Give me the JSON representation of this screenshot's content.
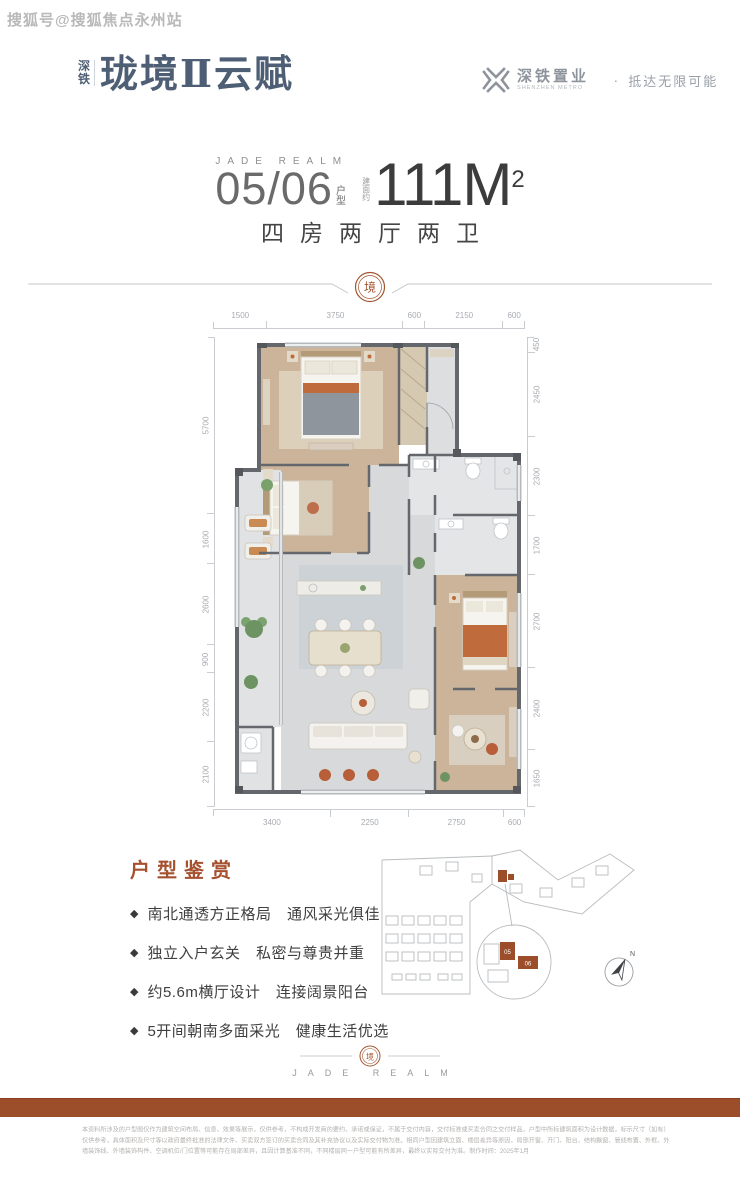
{
  "watermark": "搜狐号@搜狐焦点永州站",
  "logo": {
    "prefix_top": "深",
    "prefix_bottom": "铁",
    "name": "珑境Ⅱ云赋"
  },
  "developer": {
    "name": "深铁置业",
    "name_en": "SHENZHEN METRO",
    "separator": "·",
    "slogan": "抵达无限可能"
  },
  "headline": {
    "en_label": "JADE REALM",
    "unit_number": "05/06",
    "unit_label": "户型",
    "area_prefix": "建面约",
    "area_value": "111M",
    "area_exponent": "2",
    "rooms": "四房两厅两卫"
  },
  "divider": {
    "seal_char": "境"
  },
  "floorplan": {
    "dims_top": [
      "1500",
      "3750",
      "600",
      "2150",
      "600"
    ],
    "dims_left": [
      "5700",
      "1600",
      "2600",
      "900",
      "2200",
      "2100"
    ],
    "dims_right": [
      "450",
      "2450",
      "2300",
      "1700",
      "2700",
      "2400",
      "1650"
    ],
    "dims_bottom": [
      "3400",
      "2250",
      "2750",
      "600"
    ]
  },
  "features": {
    "title": "户型鉴赏",
    "bullet": "◆",
    "items": [
      "南北通透方正格局　通风采光俱佳",
      "独立入户玄关　私密与尊贵并重",
      "约5.6m横厅设计　连接阔景阳台",
      "5开间朝南多面采光　健康生活优选"
    ]
  },
  "siteplan": {
    "compass_label": "N",
    "unit_labels": [
      "05",
      "06"
    ]
  },
  "footer": {
    "seal_char": "境",
    "en_label": "JADE REALM"
  },
  "disclaimer": {
    "line1": "本资料所涉及的户型图仅作为建筑空间布局、信息、效果等展示，仅供参考，不构成开发商的要约、承诺或保证，不属于交付内容，交付标准或买卖合同之交付样品，户型中所标建筑面积为设计数据，标示尺寸（如有）",
    "line2": "仅供参考，具体面积及尺寸等以政府最终批准的法律文件、买卖双方签订的买卖合同及其补充协议以及实际交付物为准。相同户型因建筑立面、楼层差异等原因，局部开窗、开门、阳台、结构飘窗、管线布置、外框、外",
    "line3": "墙装饰线、外墙装饰构件、空调机位/门位置等可能存在局部差异，且因计算基准不同，不同楼层同一户型可能有所差异，最终以实际交付为准。制作时间：2025年1月"
  },
  "colors": {
    "accent_brown": "#9c4e2a",
    "logo_blue": "#4e5e74",
    "wall_gray": "#64686c",
    "wood_floor": "#cbb499"
  }
}
